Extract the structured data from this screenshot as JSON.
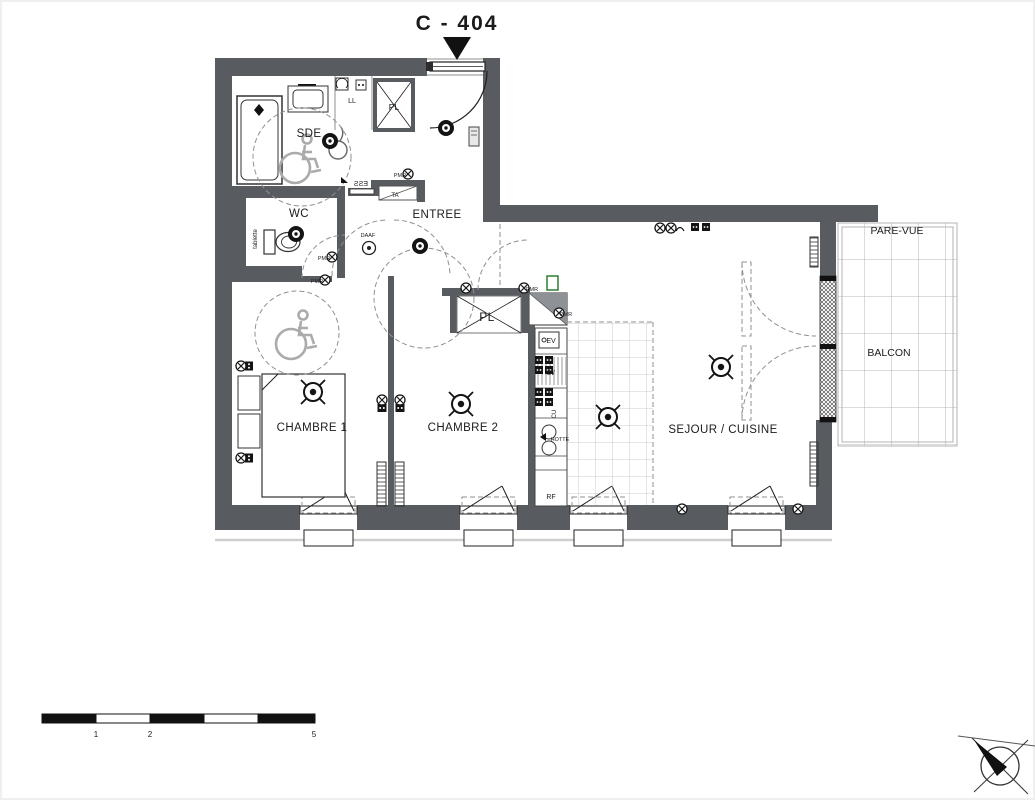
{
  "header": {
    "unit_label": "C - 404"
  },
  "rooms": {
    "sde": "SDE",
    "wc": "WC",
    "entree": "ENTREE",
    "chambre1": "CHAMBRE 1",
    "chambre2": "CHAMBRE 2",
    "sejour_cuisine": "SEJOUR / CUISINE",
    "balcon": "BALCON",
    "pare_vue": "PARE-VUE",
    "placard_sde": "PL",
    "placard_entree": "PL"
  },
  "equipment": {
    "lave_linge": "LL",
    "evier": "EV",
    "lave_vaisselle": "LV",
    "cuisson": "CU",
    "hotte": "HOTTE",
    "refrigerateur": "RF",
    "tableau_abonne": "TA",
    "tablette": "tablette",
    "detecteur_fumee": "DAAF",
    "seuil": "ESS",
    "pmr": "PMR"
  },
  "scale_bar": {
    "unit_labels": [
      "1",
      "2",
      "5"
    ]
  },
  "colors": {
    "wall": "#585c60",
    "accent_green": "#2f7d32",
    "line_dark": "#1f1f1f",
    "line_light": "#909090"
  }
}
